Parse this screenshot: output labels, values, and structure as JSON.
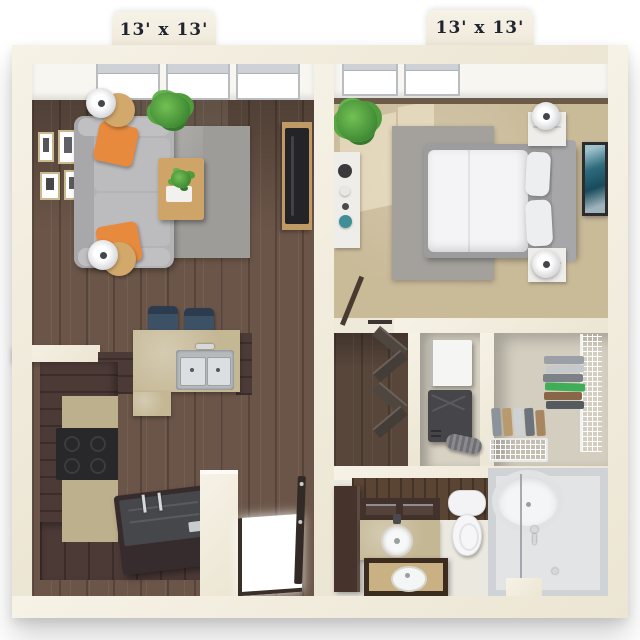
{
  "labels": {
    "left_room_dimension": "13' x 13'",
    "right_room_dimension": "13' x 13'"
  },
  "rooms": [
    {
      "id": "living-room",
      "dimension": "13' x 13'",
      "contents": [
        "gray sofa",
        "orange throw pillows",
        "two round side tables with lamps",
        "wood coffee table with tray and plant",
        "gray area rug",
        "tv on wood console",
        "houseplant",
        "four gallery frames",
        "skylight windows"
      ]
    },
    {
      "id": "bedroom",
      "dimension": "13' x 13'",
      "contents": [
        "bed with white duvet",
        "two pillows",
        "gray upholstered headboard",
        "two white nightstands with lamps",
        "white console table with decor",
        "teal wall art",
        "gray area rug",
        "tan carpet",
        "houseplant",
        "open door"
      ]
    },
    {
      "id": "kitchen",
      "contents": [
        "espresso l-shaped cabinets",
        "black cooktop and oven",
        "tan breakfast bar",
        "stainless double sink with faucet",
        "two navy bar stools",
        "dark island with chrome hardware"
      ]
    },
    {
      "id": "hallway-closet",
      "contents": [
        "wood floor",
        "dark bifold closet doors"
      ]
    },
    {
      "id": "utility-closet",
      "contents": [
        "white water heater",
        "dark furnace",
        "flex duct"
      ]
    },
    {
      "id": "walk-in-closet",
      "contents": [
        "wire shelving",
        "stacks of folded clothes",
        "wire basket drawer"
      ]
    },
    {
      "id": "bathroom",
      "contents": [
        "dark wood accent wall",
        "tall espresso cabinet",
        "vanity with round vessel sink",
        "framed mirror with sink reflection",
        "toilet",
        "shower with oval tub and glass panel"
      ]
    },
    {
      "id": "entry",
      "contents": [
        "open front door",
        "bright doorway"
      ]
    }
  ],
  "palette": {
    "background": "#ffffff",
    "wall": "#efe9da",
    "wood_floor": "#6b5548",
    "cabinet_espresso": "#4c3a37",
    "counter_tan": "#c4b794",
    "carpet_tan": "#c9ba98",
    "rug_gray": "#9d9c98",
    "sofa_gray": "#b4b3b6",
    "pillow_orange": "#e78a3e",
    "stool_navy": "#3d5166",
    "appliance_black": "#28272a",
    "stainless": "#c6c9cb",
    "bath_tile": "#ebe8e0",
    "shower_gray": "#d7dadc",
    "accent_wood": "#5a4434",
    "plant_green": "#57a743",
    "art_teal": "#2e6b7d",
    "label_text": "#1f2430"
  }
}
